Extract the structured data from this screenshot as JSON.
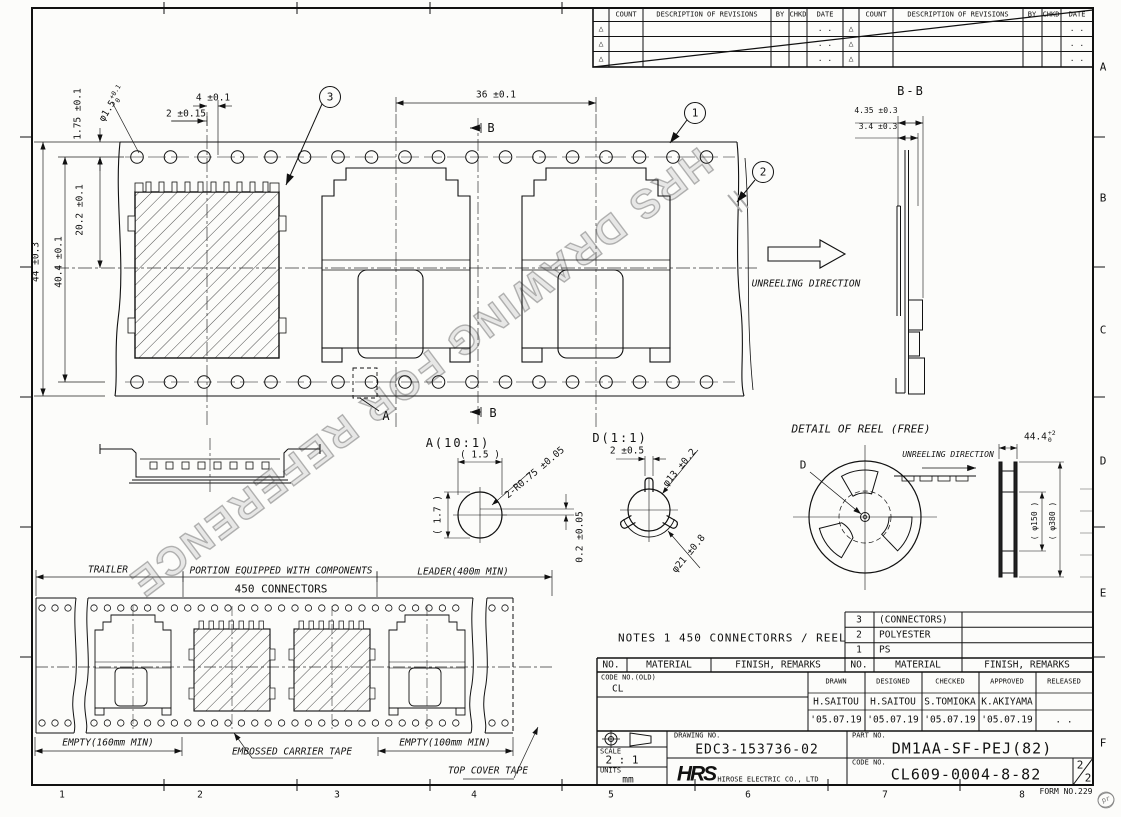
{
  "watermark": "HRS DRAWING FOR REFERENCE",
  "revisions": {
    "count": "COUNT",
    "description": "DESCRIPTION OF REVISIONS",
    "by": "BY",
    "chkd": "CHKD",
    "date": "DATE",
    "date_dots": ". .",
    "triangle": "△"
  },
  "zones": {
    "letters": [
      "A",
      "B",
      "C",
      "D",
      "E",
      "F"
    ],
    "numbers": [
      "1",
      "2",
      "3",
      "4",
      "5",
      "6",
      "7",
      "8"
    ]
  },
  "main_view": {
    "dim_tape_width": "44 ±0.3",
    "dim_hole_span": "40.4 ±0.1",
    "dim_edge_to_hole": "1.75 ±0.1",
    "hole_dia": "φ1.5",
    "hole_dia_tol_up": "+0.1",
    "hole_dia_tol_dn": "0",
    "dim_hole_to_pocket": "2 ±0.15",
    "dim_pocket_offset": "4 ±0.1",
    "dim_center_to_hole": "20.2 ±0.1",
    "dim_pocket_pitch": "36 ±0.1",
    "balloon_1": "1",
    "balloon_2": "2",
    "balloon_3": "3",
    "section_label_b": "B",
    "detail_label_a": "A",
    "unreeling_direction": "UNREELING DIRECTION"
  },
  "section_bb": {
    "title": "B-B",
    "dim_outer": "4.35 ±0.3",
    "dim_inner": "3.4 ±0.3"
  },
  "detail_a": {
    "title": "A(10:1)",
    "dim_width": "( 1.5 )",
    "dim_height": "( 1.7 )",
    "dim_radius": "2-R0.75 ±0.05",
    "dim_offset": "0.2 ±0.05"
  },
  "detail_d": {
    "title": "D(1:1)",
    "dim_tab": "2 ±0.5",
    "dim_dia13": "φ13 ±0.2",
    "dim_dia21": "φ21 ±0.8"
  },
  "reel": {
    "title": "DETAIL OF REEL (FREE)",
    "unreeling_direction": "UNREELING DIRECTION",
    "detail_label": "D",
    "dim_width": "44.4",
    "dim_width_tol_up": "+2",
    "dim_width_tol_dn": "0",
    "dim_hub": "( φ150 )",
    "dim_flange": "( φ380 )"
  },
  "strip": {
    "trailer": "TRAILER",
    "portion": "PORTION EQUIPPED WITH COMPONENTS",
    "connectors": "450 CONNECTORS",
    "leader": "LEADER(400m MIN)",
    "empty_left": "EMPTY(160mm MIN)",
    "carrier": "EMBOSSED CARRIER TAPE",
    "empty_right": "EMPTY(100mm MIN)",
    "cover": "TOP COVER TAPE"
  },
  "notes": "NOTES 1  450 CONNECTORRS / REEL",
  "materials": {
    "header": {
      "no": "NO.",
      "material": "MATERIAL",
      "finish": "FINISH, REMARKS"
    },
    "rows": [
      {
        "no": "3",
        "material": "(CONNECTORS)"
      },
      {
        "no": "2",
        "material": "POLYESTER"
      },
      {
        "no": "1",
        "material": "PS"
      }
    ]
  },
  "title_block": {
    "code_old_label": "CODE NO.(OLD)",
    "code_old_value": "CL",
    "roles": {
      "drawn": "DRAWN",
      "designed": "DESIGNED",
      "checked": "CHECKED",
      "approved": "APPROVED",
      "released": "RELEASED"
    },
    "signers": {
      "drawn": "H.SAITOU",
      "designed": "H.SAITOU",
      "checked": "S.TOMIOKA",
      "approved": "K.AKIYAMA"
    },
    "dates": {
      "drawn": "'05.07.19",
      "designed": "'05.07.19",
      "checked": "'05.07.19",
      "approved": "'05.07.19",
      "released": ". ."
    },
    "scale_label": "SCALE",
    "scale_value": "2 : 1",
    "units_label": "UNITS",
    "units_value": "mm",
    "drawing_no_label": "DRAWING NO.",
    "drawing_no": "EDC3-153736-02",
    "logo": "HRS",
    "company": "HIROSE ELECTRIC CO., LTD",
    "part_no_label": "PART NO.",
    "part_no": "DM1AA-SF-PEJ(82)",
    "code_no_label": "CODE NO.",
    "code_no": "CL609-0004-8-82",
    "sheet_num": "2",
    "sheet_total": "2",
    "form_no": "FORM NO.229",
    "stamp": "pr"
  }
}
